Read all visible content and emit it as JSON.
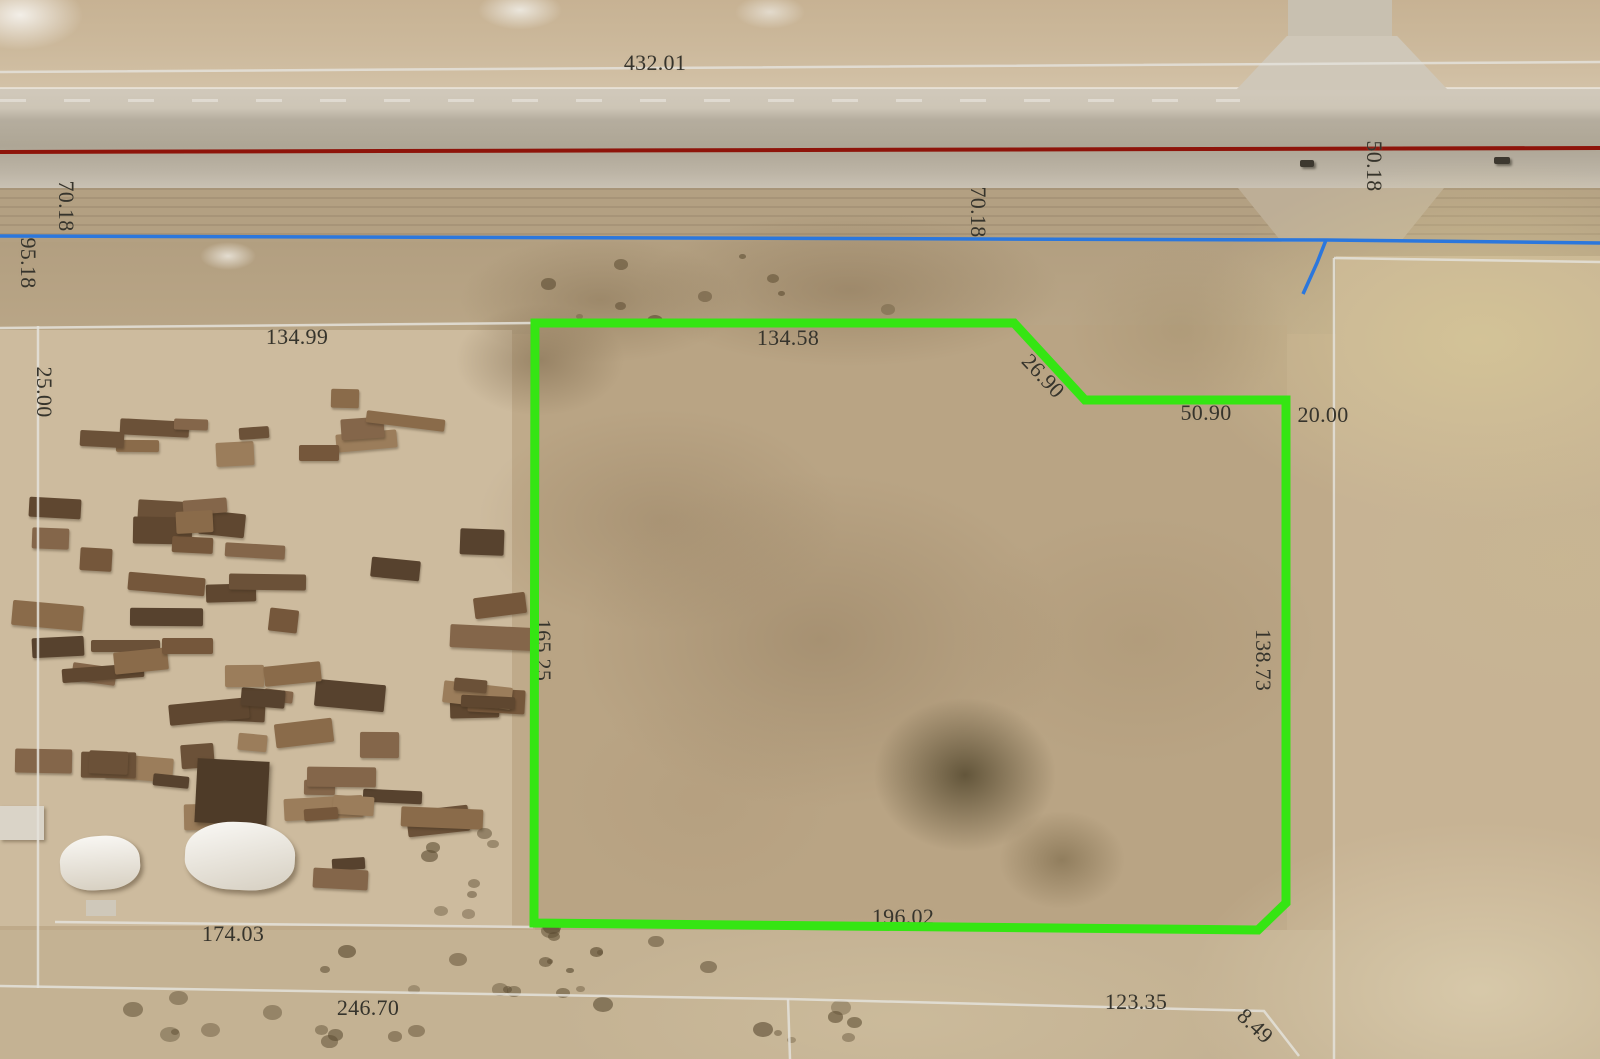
{
  "map": {
    "overlay_colors": {
      "parcel_highlight_green": "#35e513",
      "road_centerline_red": "#8e140a",
      "boundary_blue": "#2b77dd",
      "parcel_line_gray": "#e4e2db",
      "label_text": "#36342c"
    },
    "dimension_labels": [
      {
        "text": "432.01",
        "x": 655,
        "y": 63,
        "rotate": 0,
        "under_parcel_line": false
      },
      {
        "text": "50.18",
        "x": 1374,
        "y": 166,
        "rotate": 90,
        "under_parcel_line": false
      },
      {
        "text": "70.18",
        "x": 66,
        "y": 206,
        "rotate": 90,
        "under_parcel_line": false
      },
      {
        "text": "95.18",
        "x": 28,
        "y": 263,
        "rotate": 90,
        "under_parcel_line": false
      },
      {
        "text": "70.18",
        "x": 978,
        "y": 212,
        "rotate": 90,
        "under_parcel_line": false
      },
      {
        "text": "134.99",
        "x": 297,
        "y": 337,
        "rotate": 0,
        "under_parcel_line": false
      },
      {
        "text": "25.00",
        "x": 44,
        "y": 392,
        "rotate": 90,
        "under_parcel_line": false
      },
      {
        "text": "134.58",
        "x": 788,
        "y": 338,
        "rotate": 0,
        "under_parcel_line": true
      },
      {
        "text": "26.90",
        "x": 1043,
        "y": 376,
        "rotate": 47,
        "under_parcel_line": false
      },
      {
        "text": "50.90",
        "x": 1206,
        "y": 413,
        "rotate": 0,
        "under_parcel_line": false
      },
      {
        "text": "20.00",
        "x": 1323,
        "y": 415,
        "rotate": 0,
        "under_parcel_line": false
      },
      {
        "text": "165.25",
        "x": 543,
        "y": 650,
        "rotate": 90,
        "under_parcel_line": true
      },
      {
        "text": "138.73",
        "x": 1263,
        "y": 660,
        "rotate": 90,
        "under_parcel_line": false
      },
      {
        "text": "174.03",
        "x": 233,
        "y": 934,
        "rotate": 0,
        "under_parcel_line": false
      },
      {
        "text": "196.02",
        "x": 903,
        "y": 917,
        "rotate": 0,
        "under_parcel_line": true
      },
      {
        "text": "246.70",
        "x": 368,
        "y": 1008,
        "rotate": 0,
        "under_parcel_line": false
      },
      {
        "text": "123.35",
        "x": 1136,
        "y": 1002,
        "rotate": 0,
        "under_parcel_line": false
      },
      {
        "text": "8.49",
        "x": 1255,
        "y": 1026,
        "rotate": 43,
        "under_parcel_line": false
      }
    ]
  }
}
